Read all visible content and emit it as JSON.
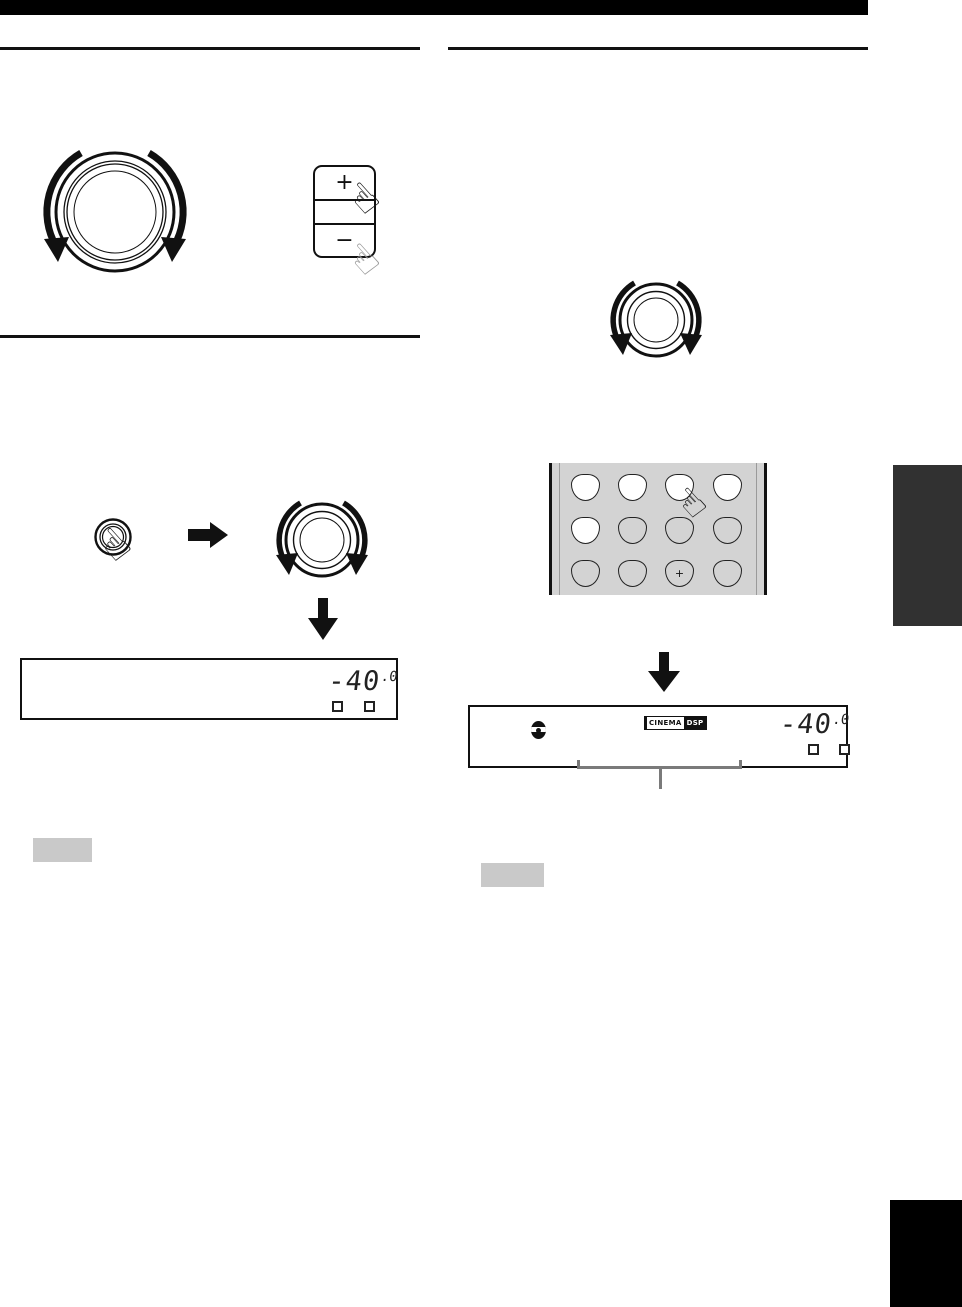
{
  "controls": {
    "volume_buttons": {
      "plus": "+",
      "minus": "−"
    },
    "remote": {
      "plus": "+"
    }
  },
  "displays": {
    "left": {
      "volume": "-40",
      "decimal": ".0"
    },
    "right": {
      "volume": "-40",
      "decimal": ".0"
    }
  },
  "logo": {
    "cinema": "CINEMA",
    "dsp": "DSP"
  },
  "icons": {
    "hand_pointer": "☝"
  },
  "colors": {
    "ink": "#111111",
    "note_box": "#c9c9c9",
    "remote_body": "#d3d3d3",
    "side_tab": "#313131",
    "bracket": "#7a7a7a"
  }
}
